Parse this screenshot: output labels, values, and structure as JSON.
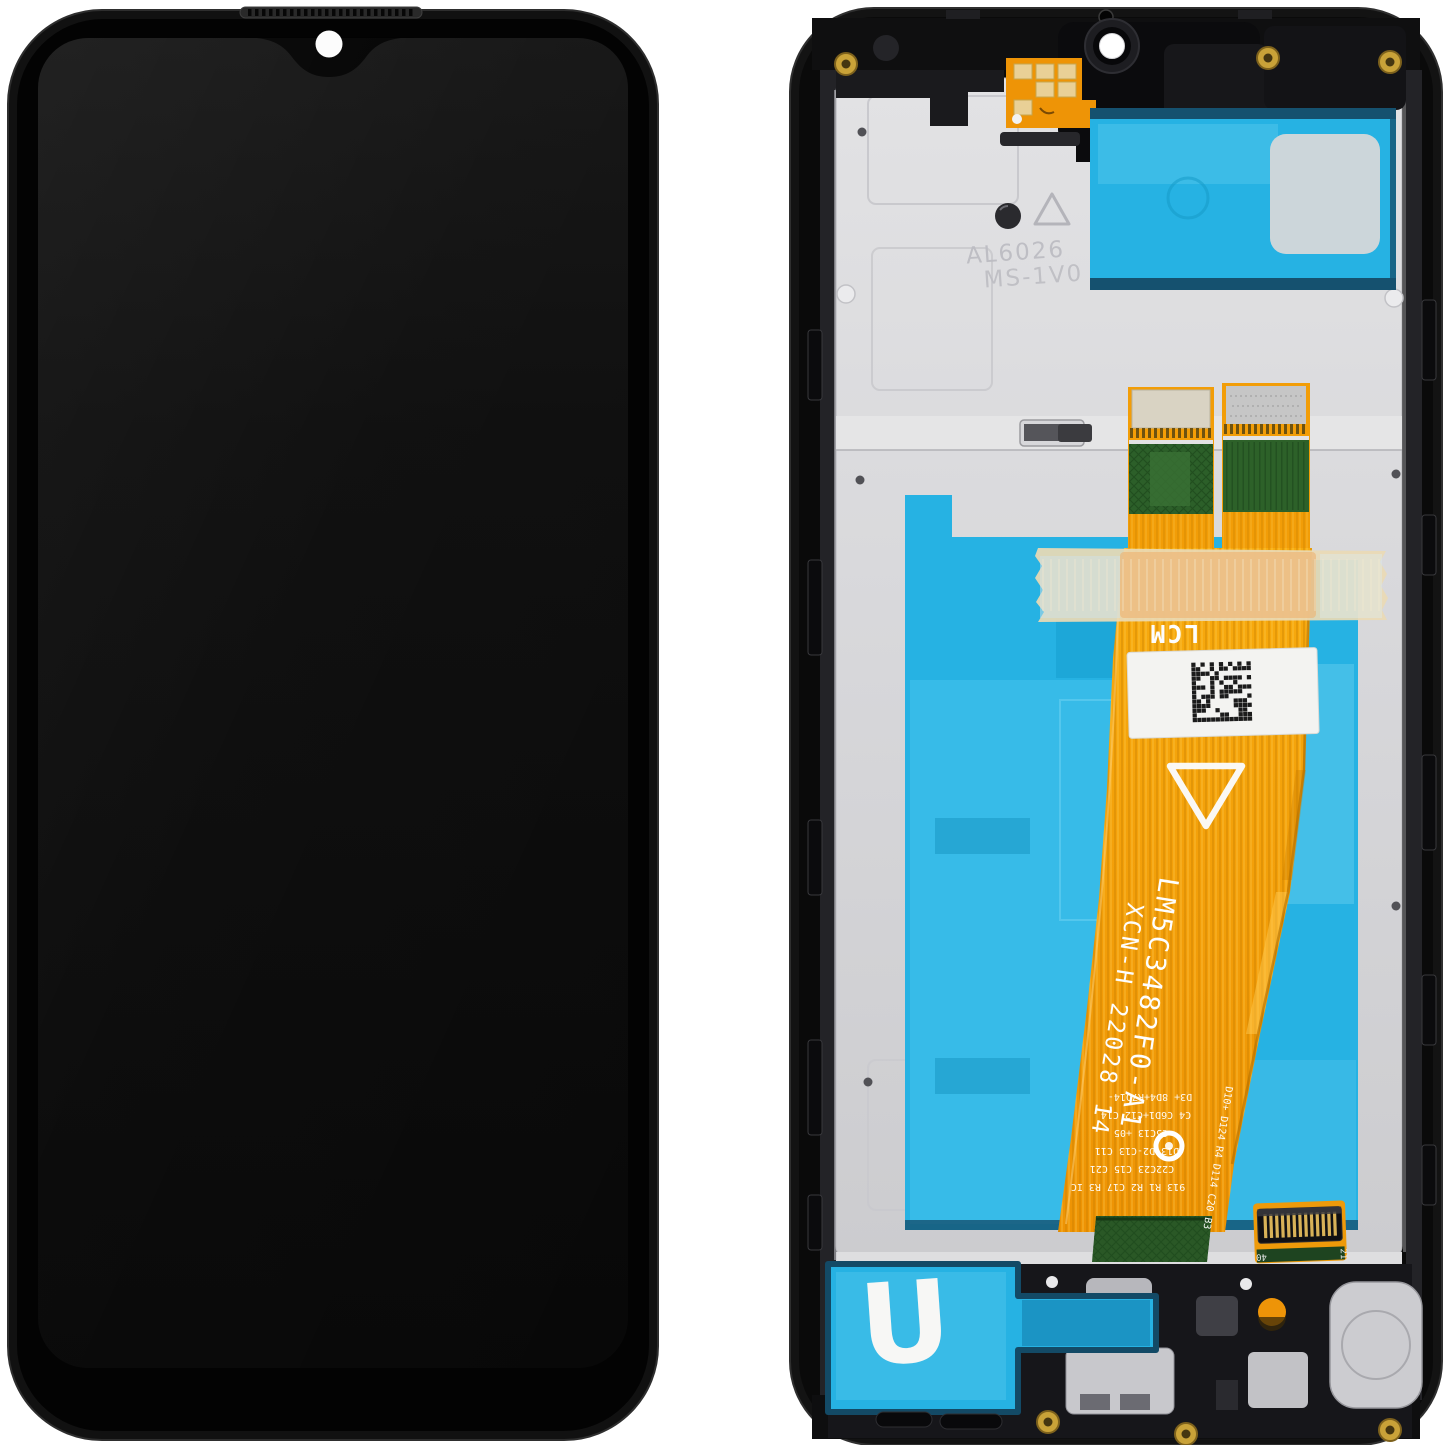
{
  "photo": {
    "background_color": "#ffffff",
    "front_view": {
      "frame_color": "#111111",
      "screen_color": "#0e0e0e",
      "camera_dot_color": "#fcfcfc"
    },
    "back_view": {
      "plate_color": "#d8d8db",
      "adhesive_cyan": "#26b2e3",
      "flex_orange": "#f5a008",
      "flex_green": "#2d6129",
      "tape_beige": "#ead9b5",
      "embossed_marking": {
        "line1": "AL6026",
        "line2": "MS-1V0"
      },
      "flex_markings": {
        "lcm": "LCM",
        "part_number": "LM5C3482F0-A1",
        "batch_code": "XCN-H 22028 14"
      },
      "component_labels": [
        "D3+ 8D4+R7D14-",
        "C4 C6D1+C12 C14",
        "C5C13 +05",
        "D13 D2-C13 C11",
        "C22C23 C15 C21",
        "913 R1 R2 C17 R3 IC",
        "D10+ D124 R4 D114 C20 B3"
      ],
      "connector_labels": {
        "left": "40",
        "right": "21"
      },
      "adhesive_letter": "U"
    }
  }
}
